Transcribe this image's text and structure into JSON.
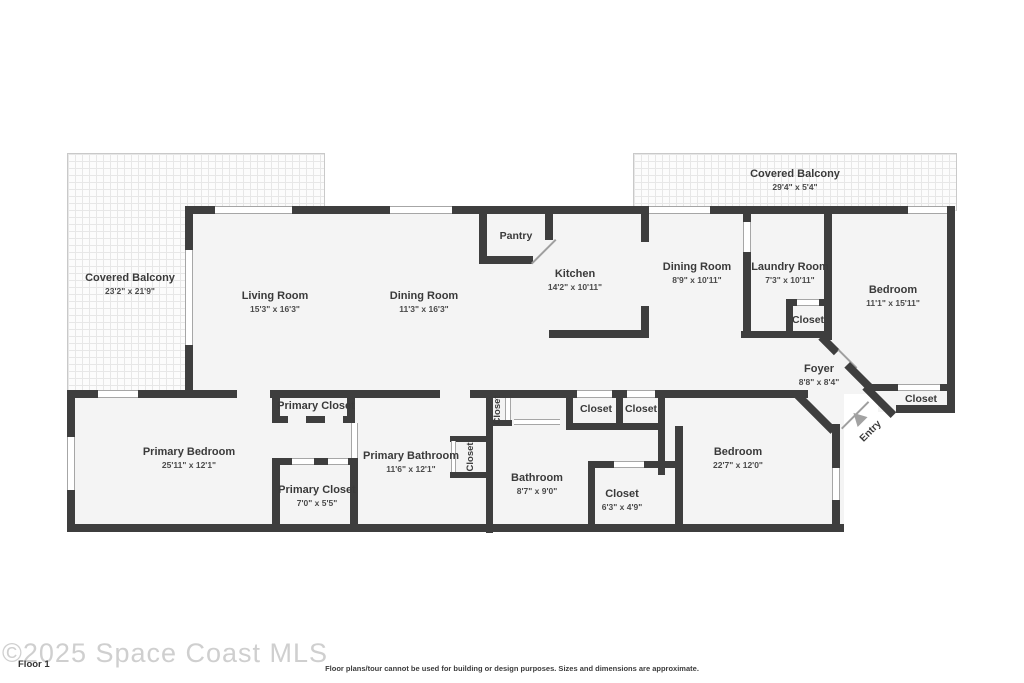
{
  "rooms": {
    "balcony_left": {
      "name": "Covered Balcony",
      "dims": "23'2\" x 21'9\""
    },
    "balcony_right": {
      "name": "Covered Balcony",
      "dims": "29'4\" x 5'4\""
    },
    "living_room": {
      "name": "Living Room",
      "dims": "15'3\" x 16'3\""
    },
    "dining_room": {
      "name": "Dining Room",
      "dims": "11'3\" x 16'3\""
    },
    "pantry": {
      "name": "Pantry"
    },
    "kitchen": {
      "name": "Kitchen",
      "dims": "14'2\" x 10'11\""
    },
    "dining_room_2": {
      "name": "Dining Room",
      "dims": "8'9\" x 10'11\""
    },
    "laundry_room": {
      "name": "Laundry Room",
      "dims": "7'3\" x 10'11\""
    },
    "bedroom_1": {
      "name": "Bedroom",
      "dims": "11'1\" x 15'11\""
    },
    "closet_laundry": {
      "name": "Closet"
    },
    "foyer": {
      "name": "Foyer",
      "dims": "8'8\" x 8'4\""
    },
    "closet_entry": {
      "name": "Closet"
    },
    "primary_closet_top": {
      "name": "Primary Closet"
    },
    "closet_hall_small": {
      "name": "Closet"
    },
    "closet_hall_1": {
      "name": "Closet"
    },
    "closet_hall_2": {
      "name": "Closet"
    },
    "primary_bedroom": {
      "name": "Primary Bedroom",
      "dims": "25'11\" x 12'1\""
    },
    "primary_bathroom": {
      "name": "Primary Bathroom",
      "dims": "11'6\" x 12'1\""
    },
    "closet_bath": {
      "name": "Closet"
    },
    "bathroom": {
      "name": "Bathroom",
      "dims": "8'7\" x 9'0\""
    },
    "primary_closet_bottom": {
      "name": "Primary Closet",
      "dims": "7'0\" x 5'5\""
    },
    "closet_bedroom_2": {
      "name": "Closet",
      "dims": "6'3\" x 4'9\""
    },
    "bedroom_2": {
      "name": "Bedroom",
      "dims": "22'7\" x 12'0\""
    }
  },
  "entry": {
    "label": "Entry"
  },
  "footer": {
    "watermark": "©2025 Space Coast MLS",
    "floor_label": "Floor 1",
    "disclaimer": "Floor plans/tour cannot be used for building or design purposes. Sizes and dimensions are approximate."
  },
  "colors": {
    "wall": "#3e3e3e",
    "floor": "#f4f4f4",
    "window_line": "#a6a6a6",
    "watermark": "#cfcfcf"
  }
}
